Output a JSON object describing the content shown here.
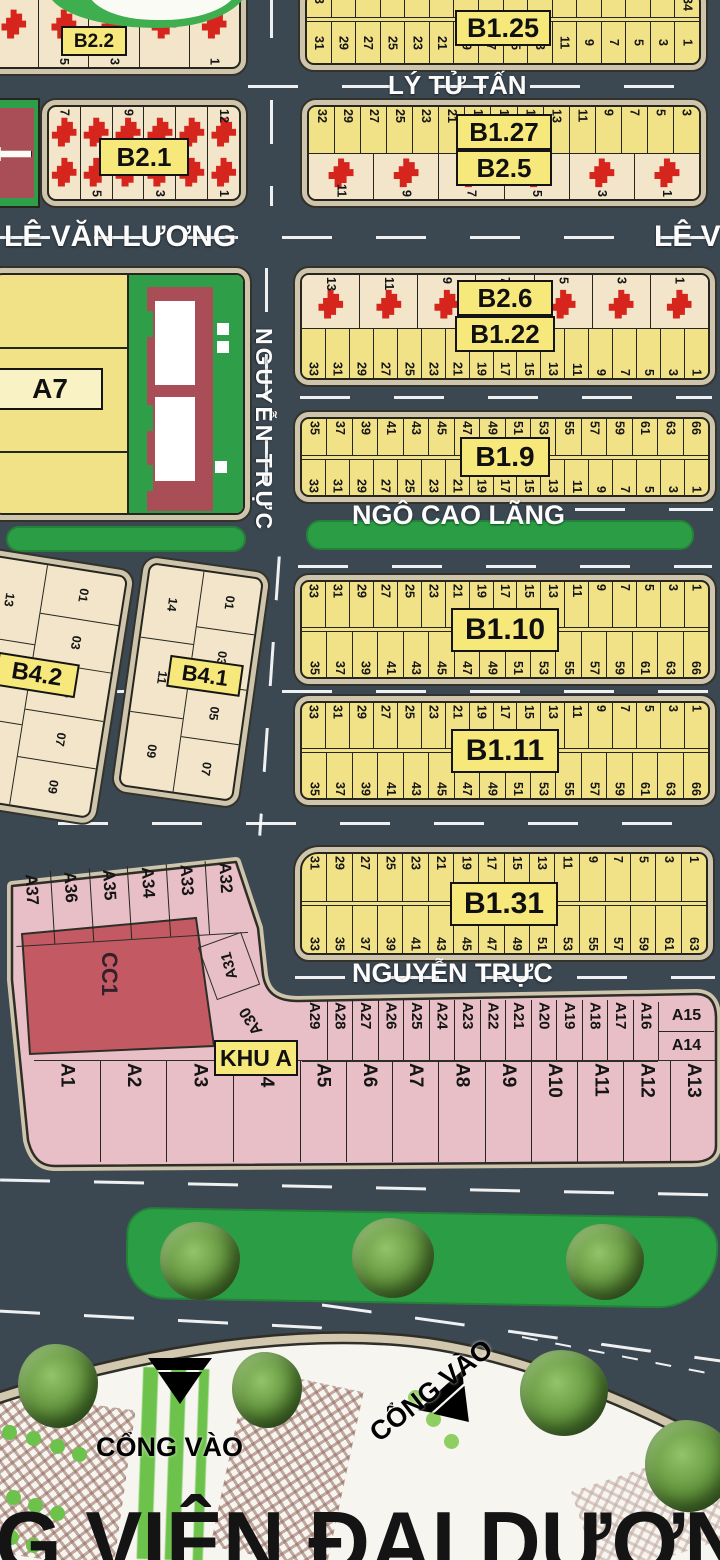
{
  "streets": {
    "ly_tu_tan": "LÝ TỬ TẤN",
    "le_van_luong": "LÊ VĂN LƯƠNG",
    "le_van_luong_partial": "LÊ V",
    "nguyen_truc": "NGUYỄN TRỰC",
    "ngo_cao_lang": "NGÔ CAO LÃNG",
    "nguyen_truc_south": "NGUYỄN TRỰC"
  },
  "blocks": {
    "b22": {
      "label": "B2.2",
      "row": [
        "",
        "5",
        "3",
        "",
        "1"
      ]
    },
    "b21": {
      "label": "B2.1",
      "row_top": [
        "7",
        "",
        "9",
        "",
        "",
        "12"
      ],
      "row_bottom": [
        "",
        "5",
        "",
        "3",
        "",
        "1"
      ]
    },
    "b125": {
      "label": "B1.25",
      "row_top": [
        "3",
        "",
        "",
        "",
        "",
        "",
        "",
        "",
        "",
        "",
        "",
        "",
        "",
        "",
        "",
        "34"
      ],
      "row_bottom": [
        "31",
        "29",
        "27",
        "25",
        "23",
        "21",
        "19",
        "17",
        "15",
        "13",
        "11",
        "9",
        "7",
        "5",
        "3",
        "1"
      ]
    },
    "b127": {
      "label": "B1.27",
      "label2": "B2.5",
      "row_top": [
        "32",
        "29",
        "27",
        "25",
        "23",
        "21",
        "19",
        "17",
        "15",
        "13",
        "11",
        "9",
        "7",
        "5",
        "3"
      ],
      "row_bottom": [
        "11",
        "9",
        "7",
        "5",
        "3",
        "1"
      ]
    },
    "b26": {
      "label": "B2.6",
      "row_top": [
        "13",
        "11",
        "9",
        "7",
        "5",
        "3",
        "1"
      ]
    },
    "b122": {
      "label": "B1.22",
      "row_bottom": [
        "33",
        "31",
        "29",
        "27",
        "25",
        "23",
        "21",
        "19",
        "17",
        "15",
        "13",
        "11",
        "9",
        "7",
        "5",
        "3",
        "1"
      ]
    },
    "b19": {
      "label": "B1.9",
      "row_top": [
        "35",
        "37",
        "39",
        "41",
        "43",
        "45",
        "47",
        "49",
        "51",
        "53",
        "55",
        "57",
        "59",
        "61",
        "63",
        "66"
      ],
      "row_bottom": [
        "33",
        "31",
        "29",
        "27",
        "25",
        "23",
        "21",
        "19",
        "17",
        "15",
        "13",
        "11",
        "9",
        "7",
        "5",
        "3",
        "1"
      ]
    },
    "b110": {
      "label": "B1.10",
      "row_top": [
        "33",
        "31",
        "29",
        "27",
        "25",
        "23",
        "21",
        "19",
        "17",
        "15",
        "13",
        "11",
        "9",
        "7",
        "5",
        "3",
        "1"
      ],
      "row_bottom": [
        "35",
        "37",
        "39",
        "41",
        "43",
        "45",
        "47",
        "49",
        "51",
        "53",
        "55",
        "57",
        "59",
        "61",
        "63",
        "66"
      ]
    },
    "b111": {
      "label": "B1.11",
      "row_top": [
        "33",
        "31",
        "29",
        "27",
        "25",
        "23",
        "21",
        "19",
        "17",
        "15",
        "13",
        "11",
        "9",
        "7",
        "5",
        "3",
        "1"
      ],
      "row_bottom": [
        "35",
        "37",
        "39",
        "41",
        "43",
        "45",
        "47",
        "49",
        "51",
        "53",
        "55",
        "57",
        "59",
        "61",
        "63",
        "66"
      ]
    },
    "b131": {
      "label": "B1.31",
      "row_top": [
        "31",
        "29",
        "27",
        "25",
        "23",
        "21",
        "19",
        "17",
        "15",
        "13",
        "11",
        "9",
        "7",
        "5",
        "3",
        "1"
      ],
      "row_bottom": [
        "33",
        "35",
        "37",
        "39",
        "41",
        "43",
        "45",
        "47",
        "49",
        "51",
        "53",
        "55",
        "57",
        "59",
        "61",
        "63"
      ]
    },
    "b42": {
      "label": "B4.2",
      "col_left": [
        "13",
        "11",
        "09"
      ],
      "col_right": [
        "01",
        "03",
        "05",
        "07",
        "09"
      ]
    },
    "b41": {
      "label": "B4.1",
      "col_left": [
        "14",
        "11",
        "09"
      ],
      "col_right": [
        "01",
        "03",
        "05",
        "07"
      ]
    },
    "a7": {
      "label": "A7"
    },
    "khu_a": {
      "label": "KHU A",
      "cc1_label": "CC1",
      "row_top": [
        "A37",
        "A36",
        "A35",
        "A34",
        "A33",
        "A32"
      ],
      "lot_a31": "A31",
      "lot_a30": "A30",
      "row_side": [
        "A29",
        "A28",
        "A27",
        "A26",
        "A25",
        "A24",
        "A23",
        "A22",
        "A21",
        "A20",
        "A19",
        "A18",
        "A17",
        "A16"
      ],
      "corner": [
        "A15",
        "A14"
      ],
      "row_bottom": [
        "A1",
        "A2",
        "A3",
        "A4",
        "A5",
        "A6",
        "A7",
        "A8",
        "A9",
        "A10",
        "A11",
        "A12",
        "A13"
      ]
    }
  },
  "gates": {
    "gate_1": "CỔNG VÀO",
    "gate_2": "CỔNG VÀO"
  },
  "park": {
    "name_partial": "CÔNG VIÊN ĐẠI DƯƠNG"
  },
  "colors": {
    "road": "#3b4751",
    "lot_yellow": "#f2e287",
    "lot_cream": "#f2e5c9",
    "lot_pink": "#e8bfc7",
    "block_border_tan": "#cfc5ad",
    "line_dark": "#26261f",
    "building_red": "#d6251d",
    "label_yellow": "#f6e87a",
    "green": "#2b9e45",
    "cc1_red": "#c35a63",
    "a7_maroon": "#a94e56",
    "park_bg": "#f7f5f0",
    "hatch_brown": "#92685c",
    "path_green": "#6cc24a",
    "accent_red": "#e02318",
    "street_text": "#fdfdfd"
  }
}
